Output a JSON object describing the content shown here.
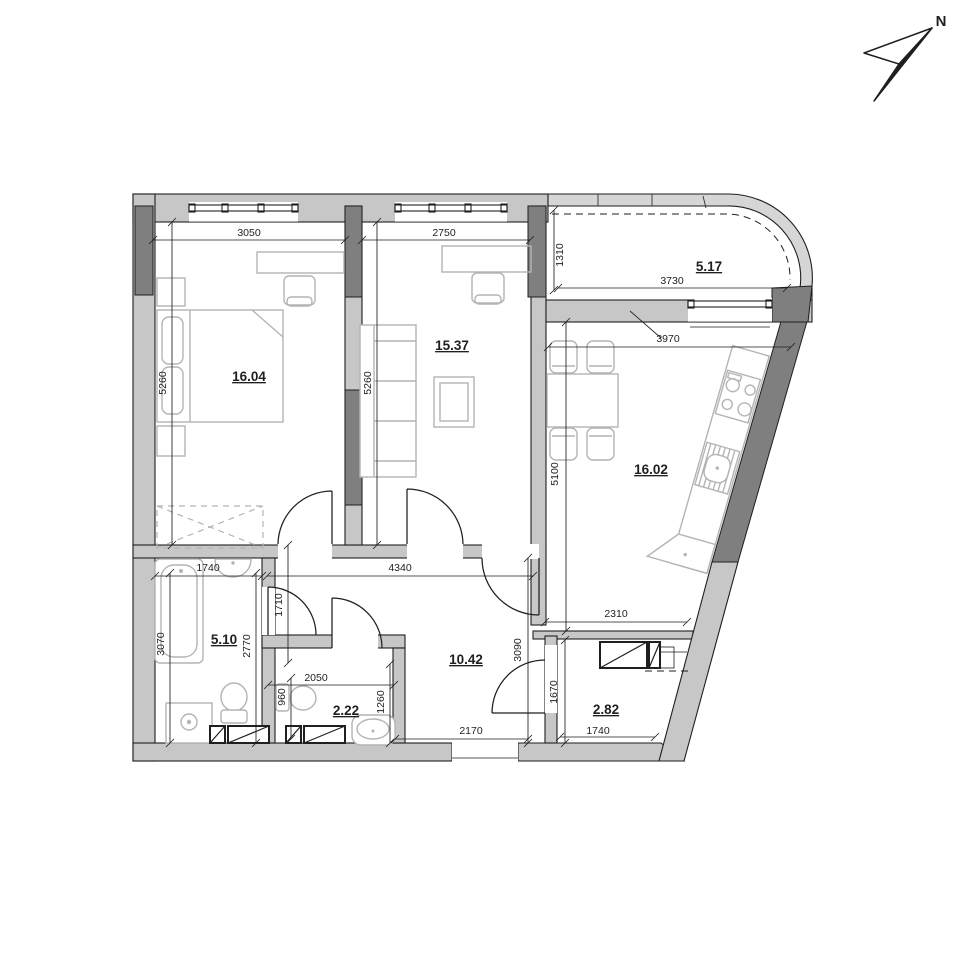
{
  "north": {
    "label": "N"
  },
  "rooms": {
    "bedroom": {
      "area": "16.04"
    },
    "living_room": {
      "area": "15.37"
    },
    "balcony": {
      "area": "5.17"
    },
    "kitchen_living": {
      "area": "16.02"
    },
    "bathroom": {
      "area": "5.10"
    },
    "wc": {
      "area": "2.22"
    },
    "hallway": {
      "area": "10.42"
    },
    "wardrobe_room": {
      "area": "2.82"
    }
  },
  "dimensions_mm": {
    "bedroom_width": "3050",
    "living_width": "2750",
    "balcony_depth": "1310",
    "balcony_width": "3730",
    "kitchen_top_width": "3970",
    "bedroom_depth": "5260",
    "living_depth": "5260",
    "kitchen_depth": "5100",
    "bathroom_width": "1740",
    "hallway_top_width": "4340",
    "kitchen_bottom_width": "2310",
    "bathroom_depth": "3070",
    "bathroom_inner_depth": "2770",
    "hallway_niche_depth": "1710",
    "hallway_depth": "3090",
    "wc_width": "2050",
    "wc_niche_depth": "960",
    "wc_depth": "1260",
    "hallway_bottom_width": "2170",
    "wardrobe_room_depth": "1670",
    "wardrobe_room_width": "1740"
  },
  "colors": {
    "wall": "#c7c7c7",
    "poche": "#7f7f7f",
    "line": "#1f1f1f",
    "furniture": "#b4b4b4",
    "glazing": "#d6d6d6"
  }
}
